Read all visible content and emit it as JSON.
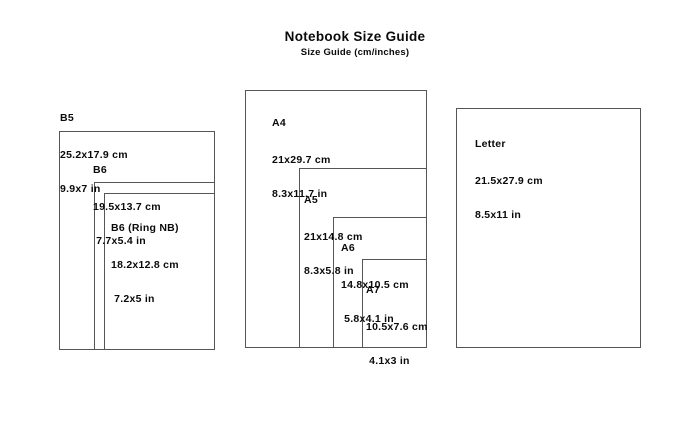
{
  "header": {
    "title": "Notebook Size Guide",
    "subtitle": "Size Guide (cm/inches)"
  },
  "sizes": {
    "b5": {
      "name": "B5",
      "cm": "25.2x17.9 cm",
      "in": "9.9x7 in"
    },
    "b6": {
      "name": "B6",
      "cm": "19.5x13.7 cm",
      "in": " 7.7x5.4 in"
    },
    "b6_ring": {
      "name": "B6 (Ring NB)",
      "cm": "18.2x12.8 cm",
      "in": " 7.2x5 in"
    },
    "a4": {
      "name": "A4",
      "cm": "21x29.7 cm",
      "in": "8.3x11.7 in"
    },
    "a5": {
      "name": "A5",
      "cm": "21x14.8 cm",
      "in": "8.3x5.8 in"
    },
    "a6": {
      "name": "A6",
      "cm": "14.8x10.5 cm",
      "in": " 5.8x4.1 in"
    },
    "a7": {
      "name": "A7",
      "cm": "10.5x7.6 cm",
      "in": " 4.1x3 in"
    },
    "letter": {
      "name": "Letter",
      "cm": "21.5x27.9 cm",
      "in": "8.5x11 in"
    }
  },
  "colors": {
    "outline": "#565656",
    "text": "#0a0a0a",
    "background": "#ffffff"
  }
}
